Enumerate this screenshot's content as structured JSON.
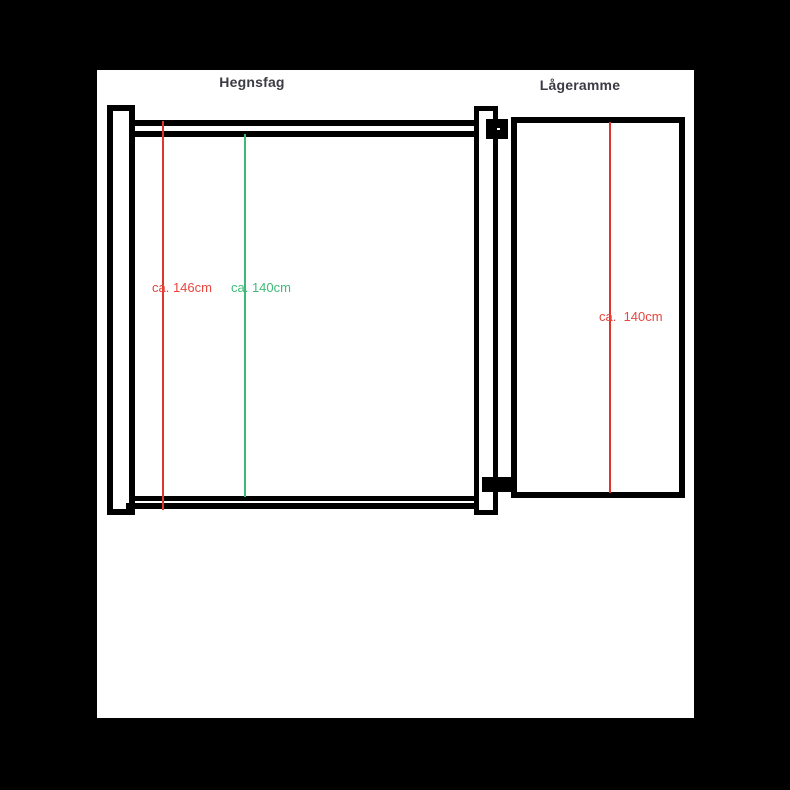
{
  "fence": {
    "title": "Hegnsfag",
    "post_height_label": "ca. 146cm",
    "frame_height_label": "ca. 140cm"
  },
  "gate": {
    "title": "Lågeramme",
    "frame_height_label": "ca.  140cm"
  },
  "colors": {
    "background": "#000000",
    "canvas": "#ffffff",
    "outline": "#000000",
    "title_text": "#3b3b44",
    "measure_red": "#e0352d",
    "measure_green": "#3eb877"
  }
}
